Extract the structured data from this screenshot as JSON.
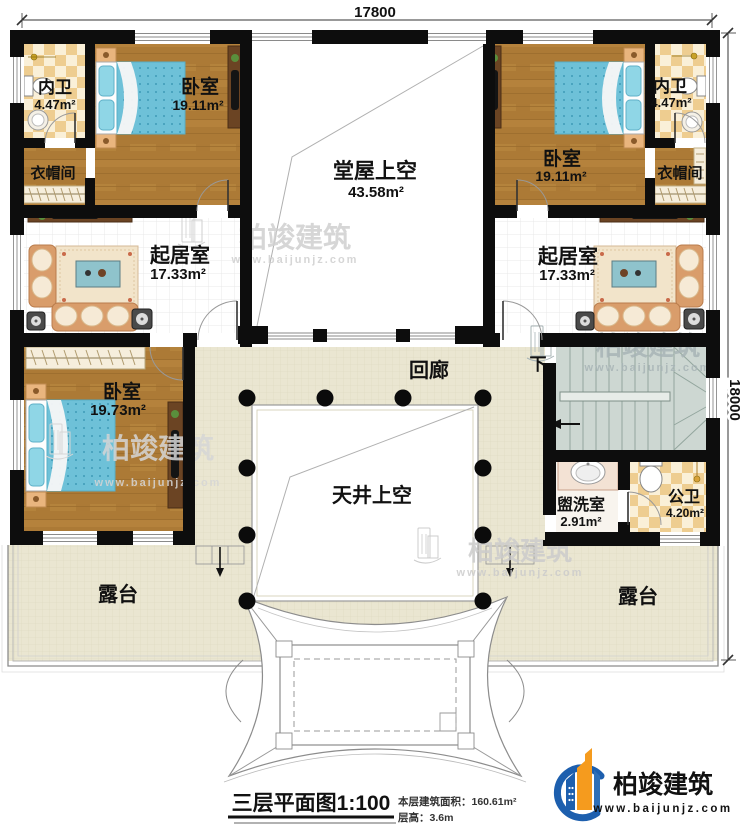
{
  "scene": {
    "type": "residential third-floor architectural plan"
  },
  "dimensions": {
    "top": "17800",
    "right": "18000"
  },
  "rooms": {
    "bath_top_left": {
      "name": "内卫",
      "area": "4.47m²"
    },
    "bedroom_top_left": {
      "name": "卧室",
      "area": "19.11m²"
    },
    "cloakroom_left": {
      "name": "衣帽间"
    },
    "hall_void": {
      "name": "堂屋上空",
      "area": "43.58m²"
    },
    "bedroom_top_right": {
      "name": "卧室",
      "area": "19.11m²"
    },
    "bath_top_right": {
      "name": "内卫",
      "area": "4.47m²"
    },
    "cloakroom_right": {
      "name": "衣帽间"
    },
    "living_left": {
      "name": "起居室",
      "area": "17.33m²"
    },
    "living_right": {
      "name": "起居室",
      "area": "17.33m²"
    },
    "bedroom_bottom_left": {
      "name": "卧室",
      "area": "19.73m²"
    },
    "corridor": {
      "name": "回廊"
    },
    "stair_down": {
      "name": "下"
    },
    "courtyard_void": {
      "name": "天井上空"
    },
    "washroom": {
      "name": "盥洗室",
      "area": "2.91m²"
    },
    "public_bath": {
      "name": "公卫",
      "area": "4.20m²"
    },
    "terrace_left": {
      "name": "露台"
    },
    "terrace_right": {
      "name": "露台"
    }
  },
  "titleblock": {
    "title": "三层平面图1:100",
    "area_line": "本层建筑面积：160.61m²",
    "floor_height_line": "层高：3.6m"
  },
  "brand": {
    "name": "柏竣建筑",
    "website": "www.baijunjz.com"
  },
  "watermark": {
    "name": "柏竣建筑",
    "website": "www.baijunjz.com"
  },
  "colors": {
    "wall": "#0d0d0d",
    "wood_floor": "#ac7a36",
    "dark_wood": "#6b4423",
    "tile_beige": "#eae6d1",
    "checker_tan": "#eecd90",
    "checker_cream": "#faf0d8",
    "bed_blue": "#6ec1d8",
    "sofa_tan": "#d99d6b",
    "stair_gray_green": "#cdd7d2",
    "brand_blue": "#1d5fae",
    "brand_orange": "#f59b1e",
    "watermark_gray": "#c9c9c9"
  }
}
